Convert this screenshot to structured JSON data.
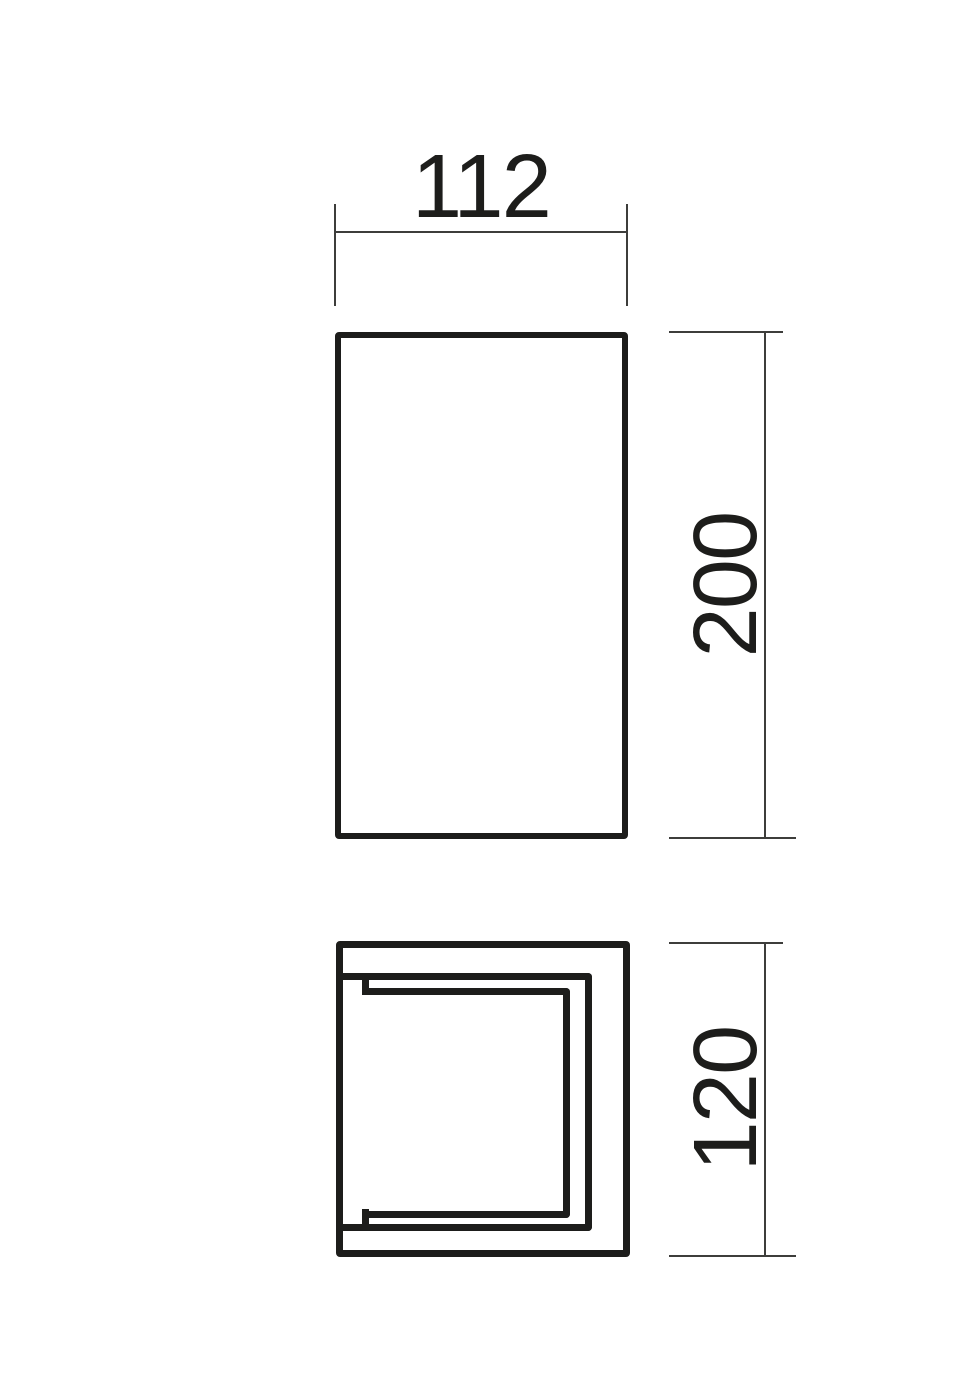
{
  "style": {
    "background": "#ffffff",
    "object_line_color": "#1d1d1b",
    "dimension_line_color": "#3d3d3b",
    "text_color": "#1d1d1b"
  },
  "drawing": {
    "type": "technical-dimension-drawing",
    "dimensions": {
      "width": {
        "value": "112"
      },
      "height": {
        "value": "200"
      },
      "depth": {
        "value": "120"
      }
    }
  }
}
